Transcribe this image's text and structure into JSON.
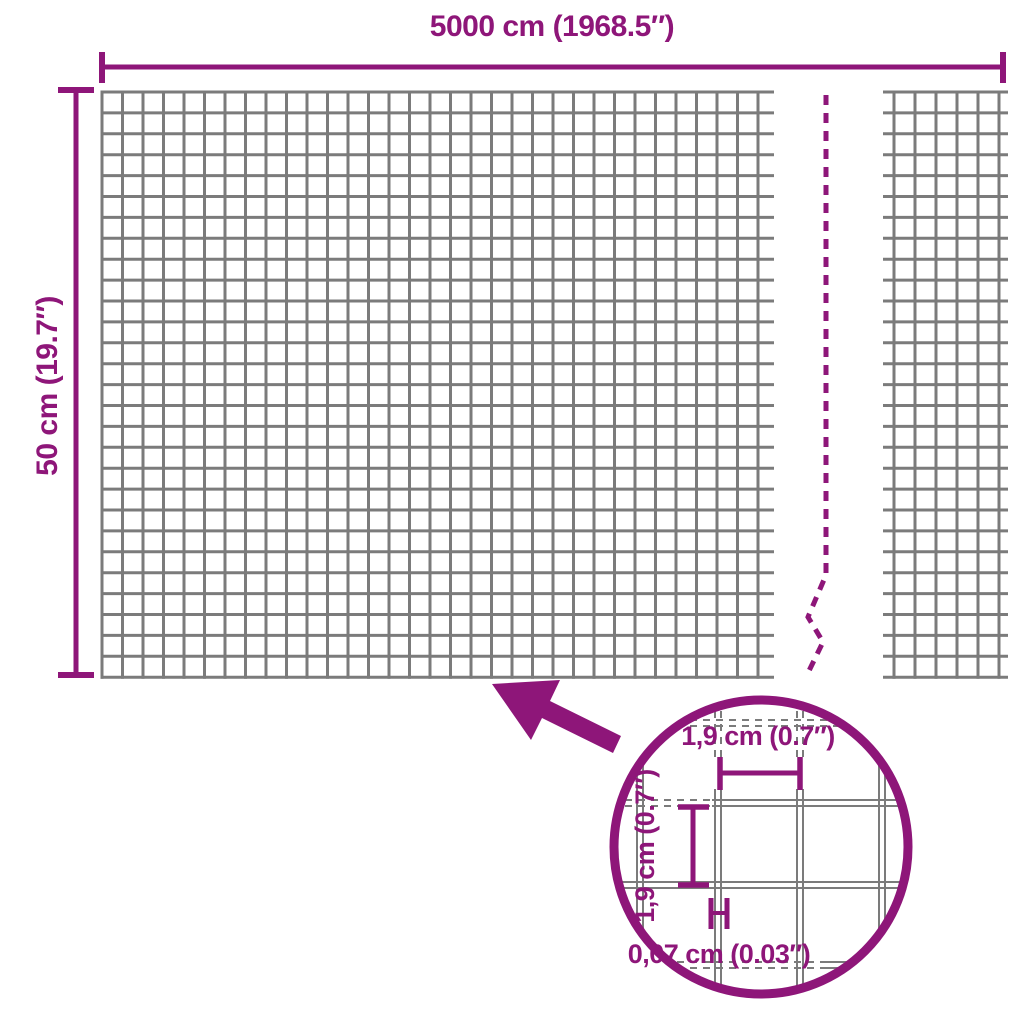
{
  "colors": {
    "accent": "#8E1679",
    "wire": "#7B7B7B"
  },
  "dimensions": {
    "width_label": "5000 cm (1968.5″)",
    "height_label": "50 cm (19.7″)"
  },
  "detail": {
    "cell_width_label": "1,9 cm (0.7″)",
    "cell_height_label": "1,9 cm (0.7″)",
    "wire_thickness_label": "0,07 cm (0.03″)"
  }
}
